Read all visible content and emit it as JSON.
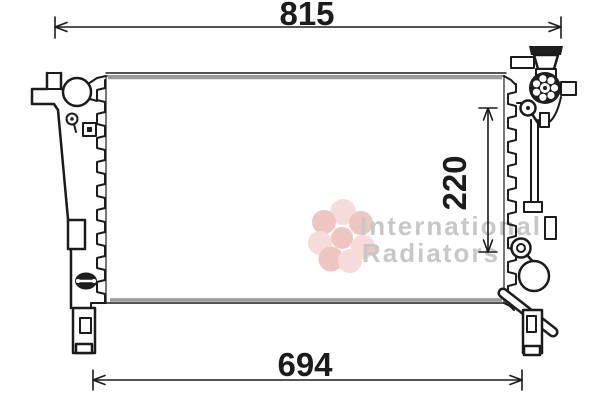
{
  "diagram": {
    "dimensions": {
      "top_width": "815",
      "bottom_width": "694",
      "side_height": "220"
    },
    "watermark": {
      "line1": "International",
      "line2": "Radiators",
      "text_color": "#c7c7c7",
      "petal_color": "#f5dcda",
      "petal_accent_color": "#edc5c1"
    },
    "colors": {
      "line": "#1b1b1b",
      "shading": "#9a9a9a",
      "background": "#ffffff"
    }
  }
}
